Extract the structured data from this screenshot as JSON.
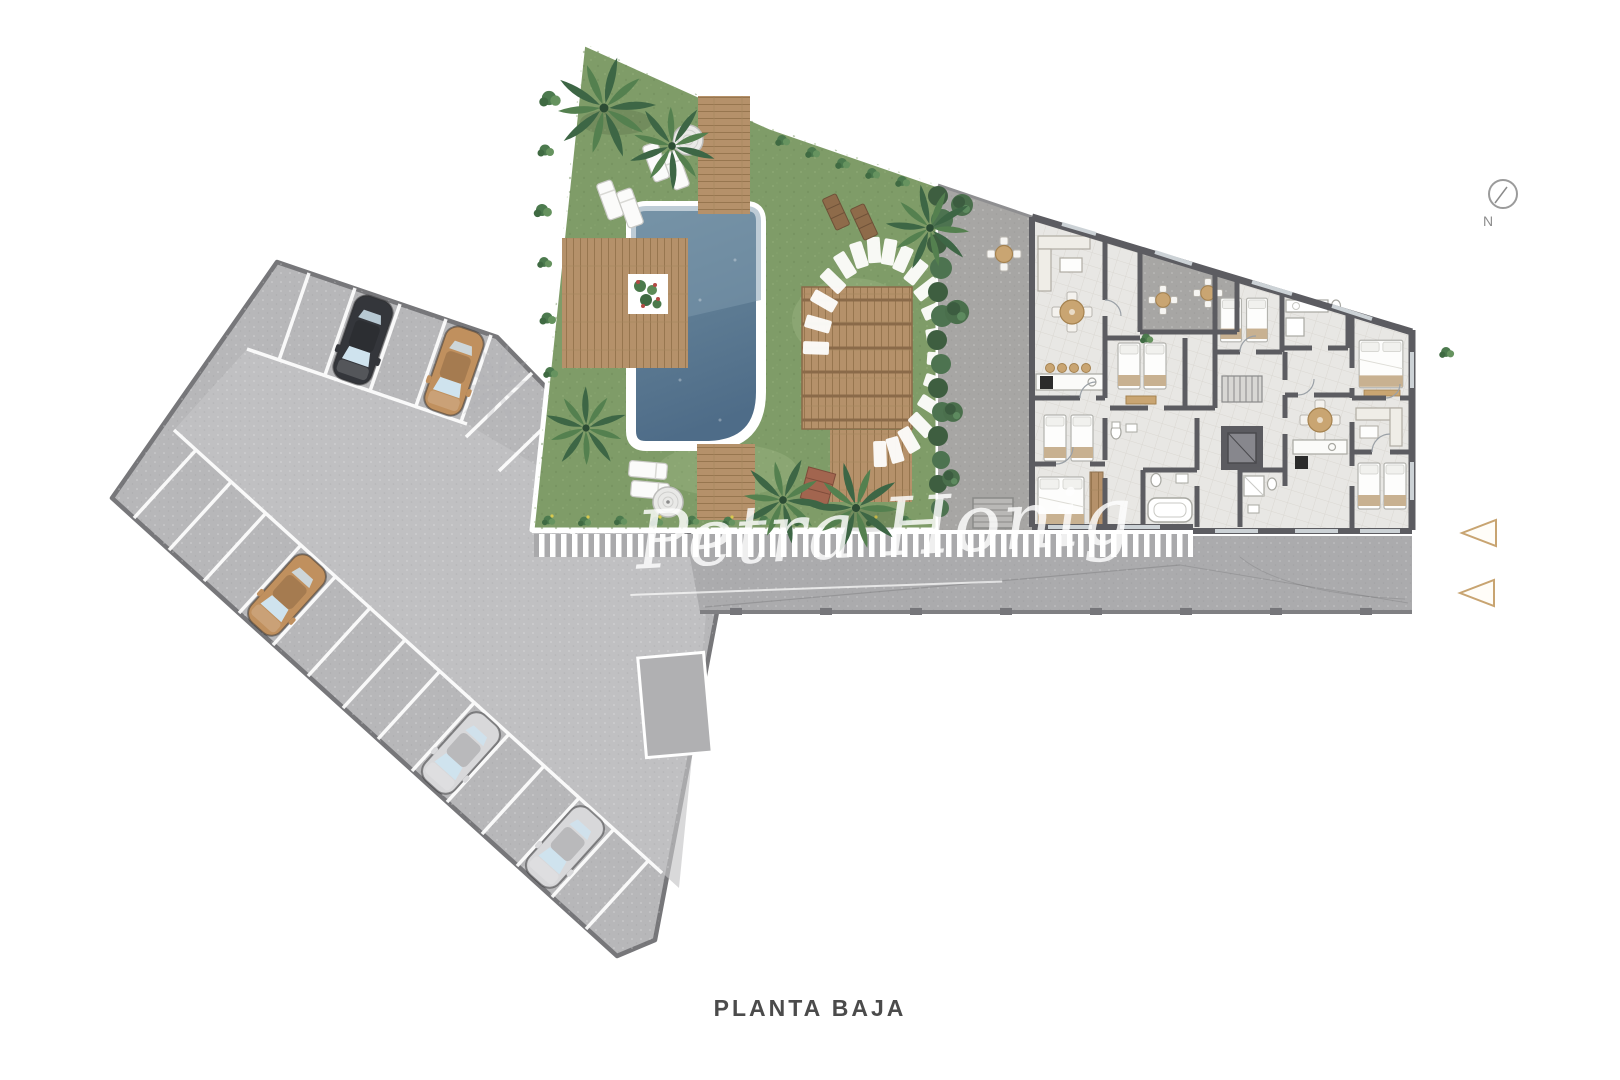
{
  "labels": {
    "floor": "PLANTA BAJA"
  },
  "watermark": {
    "text": "Petra Honig",
    "underline": true
  },
  "compass": {
    "label": "N"
  },
  "entrance_markers": {
    "count": 2,
    "stroke": "#c8a471"
  },
  "site": {
    "areas": [
      "parking-lot",
      "pool-garden",
      "terrace",
      "apartment-building",
      "access-road"
    ],
    "parking": {
      "car_count": 5,
      "cars": [
        {
          "color_name": "black",
          "hex": "#34363b"
        },
        {
          "color_name": "tan",
          "hex": "#c0905e"
        },
        {
          "color_name": "tan",
          "hex": "#c0905e"
        },
        {
          "color_name": "silver",
          "hex": "#d8d8da"
        },
        {
          "color_name": "silver",
          "hex": "#d8d8da"
        }
      ]
    },
    "garden": {
      "palm_trees": 6,
      "pool": 1,
      "parasols": 2,
      "sun_loungers": 6,
      "stepping_stones": 20,
      "pergola_decks": 2
    },
    "building": {
      "bedrooms": 7,
      "bathrooms": 5,
      "bistro_sets": 3,
      "round_dining_tables": 2,
      "elevator": 1,
      "stairs": 1
    }
  },
  "colors": {
    "background": "#ffffff",
    "grass": "#7f9c68",
    "pool_water_top": "#74909f",
    "pool_water_deep": "#4e6c88",
    "asphalt": "#b7b7b9",
    "aisle": "#c4c4c6",
    "road": "#ababad",
    "terrace": "#a7a6a4",
    "floor": "#e8e7e4",
    "wall": "#5c5c61",
    "wood_deck": "#b5916a",
    "hedge": "#43653f",
    "curb": "#7f7f82",
    "label_text": "#4b4b4b",
    "watermark": "#ffffff",
    "triangle_accent": "#c8a471"
  }
}
